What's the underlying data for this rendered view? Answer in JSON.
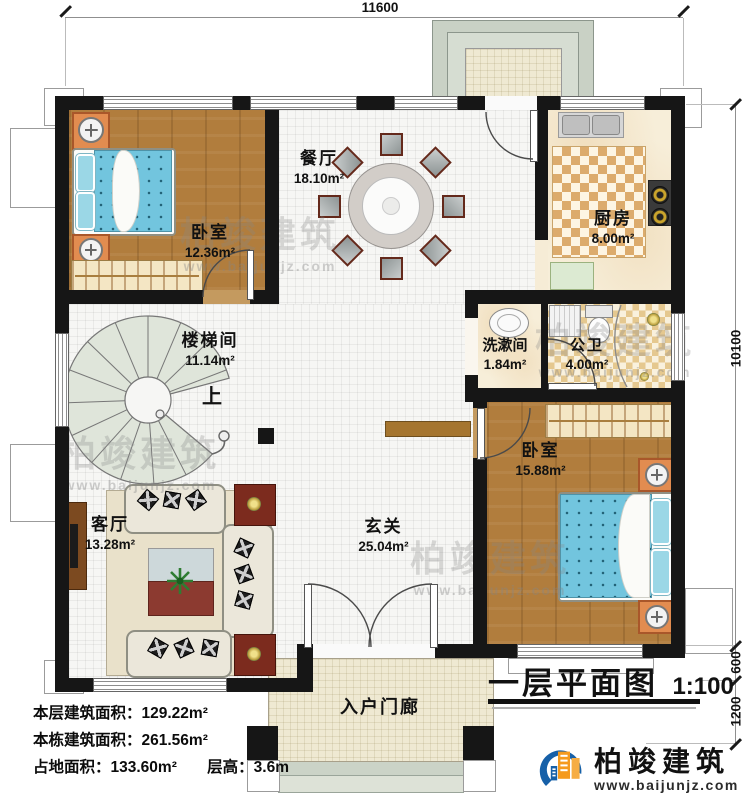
{
  "dimensions": {
    "top": "11600",
    "right": [
      "10100",
      "600",
      "1200"
    ]
  },
  "rooms": [
    {
      "name": "卧室",
      "area": "12.36m²"
    },
    {
      "name": "餐厅",
      "area": "18.10m²"
    },
    {
      "name": "厨房",
      "area": "8.00m²"
    },
    {
      "name": "楼梯间",
      "area": "11.14m²"
    },
    {
      "name": "洗漱间",
      "area": "1.84m²"
    },
    {
      "name": "公卫",
      "area": "4.00m²"
    },
    {
      "name": "卧室",
      "area": "15.88m²"
    },
    {
      "name": "客厅",
      "area": "13.28m²"
    },
    {
      "name": "玄关",
      "area": "25.04m²"
    },
    {
      "name": "入户门廊"
    }
  ],
  "stair": {
    "up_label": "上"
  },
  "stats": [
    "本层建筑面积：129.22m²",
    "本栋建筑面积：261.56m²",
    "占地面积：133.60m²",
    "层高：3.6m"
  ],
  "title_block": {
    "title": "一层平面图",
    "scale": "1:100"
  },
  "branding": {
    "name": "柏竣建筑",
    "website": "www.baijunjz.com"
  },
  "colors": {
    "wall": "#161616",
    "brand_blue": "#1660a8",
    "brand_orange": "#f59a1d"
  }
}
